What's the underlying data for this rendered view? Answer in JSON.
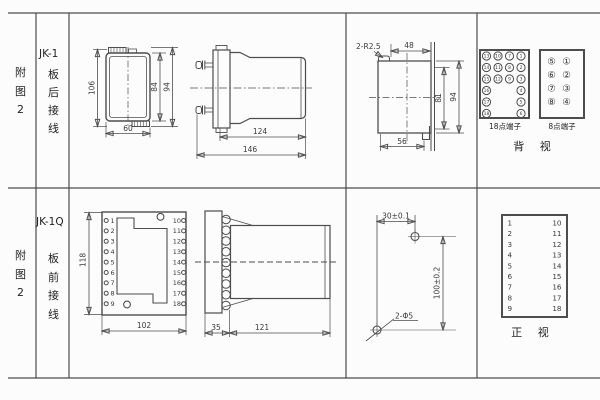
{
  "rows": {
    "r1": {
      "fig": "附图2",
      "model": "JK-1",
      "wiring": "板后接线"
    },
    "r2": {
      "fig": "附图2",
      "model": "JK-1Q",
      "wiring": "板前接线"
    }
  },
  "top": {
    "front": {
      "h106": "106",
      "h84": "84",
      "h94": "94",
      "w60": "60"
    },
    "side": {
      "w124": "124",
      "w146": "146"
    },
    "cutout": {
      "radius": "2-R2.5",
      "w48": "48",
      "h81": "81",
      "h94": "94",
      "w56": "56"
    },
    "t18": {
      "label": "18点端子",
      "nums": [
        "13",
        "10",
        "7",
        "1",
        "14",
        "11",
        "8",
        "2",
        "15",
        "12",
        "9",
        "3",
        "16",
        "4",
        "17",
        "5",
        "18",
        "6"
      ]
    },
    "t8": {
      "label": "8点端子",
      "nums": [
        "⑤",
        "①",
        "⑥",
        "②",
        "⑦",
        "③",
        "⑧",
        "④"
      ]
    },
    "view_label": "背 视"
  },
  "bottom": {
    "front": {
      "h118": "118",
      "w102": "102",
      "left": [
        "1",
        "2",
        "3",
        "4",
        "5",
        "6",
        "7",
        "8",
        "9"
      ],
      "right": [
        "10",
        "11",
        "12",
        "13",
        "14",
        "15",
        "16",
        "17",
        "18"
      ]
    },
    "side": {
      "w35": "35",
      "w121": "121"
    },
    "drill": {
      "w30": "30±0.1",
      "h100": "100±0.2",
      "holes": "2-Φ5"
    },
    "table": {
      "left": [
        "1",
        "2",
        "3",
        "4",
        "5",
        "6",
        "7",
        "8",
        "9"
      ],
      "right": [
        "10",
        "11",
        "12",
        "13",
        "14",
        "15",
        "16",
        "17",
        "18"
      ],
      "label": "正 视"
    }
  },
  "colors": {
    "line": "#4d4d4d",
    "grid": "#666666",
    "bg": "#fcfcfc"
  }
}
